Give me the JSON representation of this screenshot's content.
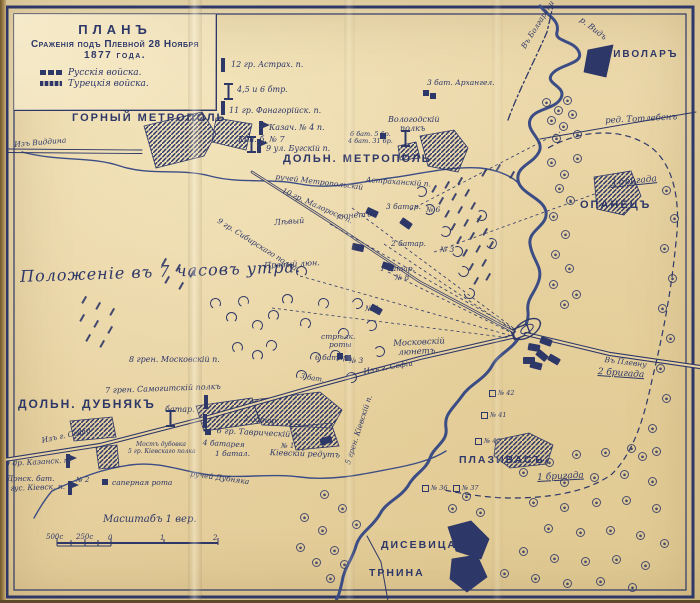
{
  "colors": {
    "ink": "#2d3768",
    "river": "#3c4d85",
    "paper": "#e8d3a3"
  },
  "title_box": {
    "line1": "ПЛАНЪ",
    "line2": "Сраженія подъ Плевной 28 Ноября",
    "line3": "1877 года.",
    "legend": [
      {
        "label": "Русскія войска.",
        "type": "russian"
      },
      {
        "label": "Турецкія войска.",
        "type": "turkish"
      }
    ]
  },
  "annotation": {
    "text": "Положеніе въ 7 часовъ утра."
  },
  "scale": {
    "label": "Масштабъ 1 вер.",
    "ticks": [
      {
        "t": "500с",
        "x": 46,
        "y": 533
      },
      {
        "t": "250с",
        "x": 76,
        "y": 533
      },
      {
        "t": "0",
        "x": 108,
        "y": 534
      },
      {
        "t": "1",
        "x": 160,
        "y": 534
      },
      {
        "t": "2",
        "x": 213,
        "y": 534
      }
    ]
  },
  "towns": [
    {
      "t": "ГОРНЫЙ МЕТРОПОЛЬ",
      "x": 72,
      "y": 112,
      "s": 11
    },
    {
      "t": "ДОЛЬН. МЕТРОПОЛЬ",
      "x": 283,
      "y": 153,
      "s": 11
    },
    {
      "t": "БИВОЛАРЪ",
      "x": 604,
      "y": 49,
      "s": 10
    },
    {
      "t": "ОПАНЕЦЪ",
      "x": 580,
      "y": 199,
      "s": 11
    },
    {
      "t": "ДОЛЬН. ДУБНЯКЪ",
      "x": 18,
      "y": 397,
      "s": 12
    },
    {
      "t": "ПЛАЗИВАСЪ",
      "x": 459,
      "y": 454,
      "s": 10.5
    },
    {
      "t": "ДИСЕВИЦА",
      "x": 381,
      "y": 539,
      "s": 10.5
    },
    {
      "t": "ТРНИНА",
      "x": 369,
      "y": 567,
      "s": 10.5
    }
  ],
  "labels": [
    {
      "t": "Изъ Виддина",
      "x": 14,
      "y": 141,
      "s": 7.5,
      "r": -5
    },
    {
      "t": "12 гр. Астрах. п.",
      "x": 231,
      "y": 61,
      "s": 8
    },
    {
      "t": "4,5 и 6 бтр.",
      "x": 237,
      "y": 86,
      "s": 8
    },
    {
      "t": "11 гр. Фанагорійск. п.",
      "x": 229,
      "y": 107,
      "s": 8
    },
    {
      "t": "Казач. № 4 п.",
      "x": 269,
      "y": 124,
      "s": 8
    },
    {
      "t": "Кон. б. № 7",
      "x": 238,
      "y": 136,
      "s": 8
    },
    {
      "t": "9 ул. Бугскій п.",
      "x": 266,
      "y": 145,
      "s": 8
    },
    {
      "t": "Вологодскій",
      "x": 388,
      "y": 116,
      "s": 8
    },
    {
      "t": "полкъ",
      "x": 400,
      "y": 125,
      "s": 8
    },
    {
      "t": "6 бат. 5 бр.",
      "x": 350,
      "y": 131,
      "s": 6.5
    },
    {
      "t": "4 бат. 31 бр.",
      "x": 348,
      "y": 138,
      "s": 6.5
    },
    {
      "t": "3 бат. Архангел.",
      "x": 427,
      "y": 79,
      "s": 7.5
    },
    {
      "t": "Въ Болгарени",
      "x": 520,
      "y": 46,
      "s": 7.5,
      "r": -58
    },
    {
      "t": "р. Видъ",
      "x": 583,
      "y": 16,
      "s": 8,
      "r": 38
    },
    {
      "t": "ред. Тотлебенъ",
      "x": 605,
      "y": 117,
      "s": 8.5,
      "r": -3
    },
    {
      "t": "3 бригада",
      "x": 610,
      "y": 180,
      "s": 9,
      "r": -6,
      "u": 1
    },
    {
      "t": "ручей Метропольскій",
      "x": 276,
      "y": 173,
      "s": 7.5,
      "r": 7
    },
    {
      "t": "10 гр. Малоросс. п.",
      "x": 284,
      "y": 187,
      "s": 7.5,
      "r": 24
    },
    {
      "t": "9 гр. Сибирскаго полка",
      "x": 220,
      "y": 217,
      "s": 7.5,
      "r": 32
    },
    {
      "t": "Астраханскій п.",
      "x": 366,
      "y": 176,
      "s": 7.5,
      "r": 4
    },
    {
      "t": "Лѣвый",
      "x": 274,
      "y": 219,
      "s": 8,
      "r": -4
    },
    {
      "t": "люнетъ",
      "x": 336,
      "y": 213,
      "s": 8,
      "r": -4
    },
    {
      "t": "3 батар.",
      "x": 386,
      "y": 203,
      "s": 7.5
    },
    {
      "t": "№ 6",
      "x": 426,
      "y": 206,
      "s": 7.5
    },
    {
      "t": "2 батар.",
      "x": 391,
      "y": 240,
      "s": 7.5
    },
    {
      "t": "№ 3",
      "x": 440,
      "y": 246,
      "s": 7.5
    },
    {
      "t": "1 батар.",
      "x": 380,
      "y": 265,
      "s": 7.5
    },
    {
      "t": "№ 8",
      "x": 395,
      "y": 274,
      "s": 7.5
    },
    {
      "t": "Правый люн.",
      "x": 264,
      "y": 262,
      "s": 8,
      "r": -3
    },
    {
      "t": "№ 1",
      "x": 365,
      "y": 305,
      "s": 7.5
    },
    {
      "t": "стрѣлк.",
      "x": 321,
      "y": 333,
      "s": 7.5
    },
    {
      "t": "роты",
      "x": 329,
      "y": 341,
      "s": 7.5
    },
    {
      "t": "Московскій",
      "x": 393,
      "y": 340,
      "s": 8.5,
      "r": -3
    },
    {
      "t": "люнетъ",
      "x": 398,
      "y": 349,
      "s": 8.5,
      "r": -3
    },
    {
      "t": "8 грен. Московскій п.",
      "x": 129,
      "y": 356,
      "s": 8
    },
    {
      "t": "6 батар.",
      "x": 315,
      "y": 354,
      "s": 7.5
    },
    {
      "t": "№ 3",
      "x": 349,
      "y": 357,
      "s": 7.5
    },
    {
      "t": "3 бат.",
      "x": 301,
      "y": 373,
      "s": 7,
      "r": 10
    },
    {
      "t": "Изъ г. Софіи",
      "x": 363,
      "y": 368,
      "s": 7.5,
      "r": -10
    },
    {
      "t": "7 грен. Самогитскій полкъ",
      "x": 105,
      "y": 387,
      "s": 8,
      "r": -2
    },
    {
      "t": "батар.",
      "x": 165,
      "y": 406,
      "s": 8
    },
    {
      "t": "Изъ г. Софіи",
      "x": 41,
      "y": 437,
      "s": 7.5,
      "r": -12
    },
    {
      "t": "3 батар.",
      "x": 244,
      "y": 415,
      "s": 7.5,
      "r": 4
    },
    {
      "t": "№ 2",
      "x": 287,
      "y": 420,
      "s": 7
    },
    {
      "t": "6 гр. Таврическій п.",
      "x": 217,
      "y": 427,
      "s": 8,
      "r": 3
    },
    {
      "t": "4 батарея",
      "x": 203,
      "y": 439,
      "s": 7.5,
      "r": 3
    },
    {
      "t": "№ 1",
      "x": 281,
      "y": 443,
      "s": 7
    },
    {
      "t": "1 батал.",
      "x": 215,
      "y": 450,
      "s": 7.5
    },
    {
      "t": "Кіевскій редутъ",
      "x": 270,
      "y": 449,
      "s": 8,
      "r": 2
    },
    {
      "t": "Мостъ дубовка",
      "x": 136,
      "y": 442,
      "s": 6
    },
    {
      "t": "5 гр. Кіевскаго полка",
      "x": 128,
      "y": 449,
      "s": 6
    },
    {
      "t": "ручей Дубняка",
      "x": 191,
      "y": 470,
      "s": 7.5,
      "r": 8
    },
    {
      "t": "5 грен. Кіевскій п.",
      "x": 344,
      "y": 463,
      "s": 7.5,
      "r": -72
    },
    {
      "t": "9 др. Казанск. п.",
      "x": 5,
      "y": 460,
      "s": 7.5,
      "r": -3
    },
    {
      "t": "Донск. бат.",
      "x": 7,
      "y": 475,
      "s": 7.5
    },
    {
      "t": "9 гус. Кіевск. п.",
      "x": 3,
      "y": 485,
      "s": 7.5,
      "r": -2
    },
    {
      "t": "№ 2",
      "x": 76,
      "y": 477,
      "s": 7
    },
    {
      "t": "саперная рота",
      "x": 112,
      "y": 479,
      "s": 7.5
    },
    {
      "t": "Въ Плевну",
      "x": 605,
      "y": 356,
      "s": 7.5,
      "r": 7
    },
    {
      "t": "2 бригада",
      "x": 598,
      "y": 368,
      "s": 9,
      "r": 4,
      "u": 1
    },
    {
      "t": "1 бригада",
      "x": 537,
      "y": 474,
      "s": 9,
      "r": -3,
      "u": 1
    }
  ],
  "numboxes": [
    {
      "n": "№ 42",
      "x": 489,
      "y": 389
    },
    {
      "n": "№ 41",
      "x": 481,
      "y": 411
    },
    {
      "n": "№ 40",
      "x": 475,
      "y": 437
    },
    {
      "n": "№ 36",
      "x": 422,
      "y": 484
    },
    {
      "n": "№ 37",
      "x": 453,
      "y": 484
    }
  ],
  "decor": {
    "bushes": [
      [
        542,
        98
      ],
      [
        554,
        106
      ],
      [
        563,
        96
      ],
      [
        547,
        116
      ],
      [
        559,
        122
      ],
      [
        568,
        110
      ],
      [
        573,
        130
      ],
      [
        552,
        134
      ],
      [
        547,
        158
      ],
      [
        560,
        170
      ],
      [
        573,
        154
      ],
      [
        555,
        184
      ],
      [
        566,
        196
      ],
      [
        549,
        212
      ],
      [
        561,
        230
      ],
      [
        551,
        250
      ],
      [
        565,
        264
      ],
      [
        549,
        280
      ],
      [
        572,
        290
      ],
      [
        560,
        300
      ],
      [
        662,
        186
      ],
      [
        670,
        214
      ],
      [
        660,
        244
      ],
      [
        668,
        274
      ],
      [
        658,
        304
      ],
      [
        666,
        334
      ],
      [
        656,
        364
      ],
      [
        662,
        394
      ],
      [
        648,
        424
      ],
      [
        638,
        452
      ],
      [
        519,
        468
      ],
      [
        545,
        458
      ],
      [
        572,
        450
      ],
      [
        601,
        448
      ],
      [
        627,
        444
      ],
      [
        652,
        447
      ],
      [
        560,
        478
      ],
      [
        590,
        473
      ],
      [
        620,
        470
      ],
      [
        648,
        477
      ],
      [
        529,
        498
      ],
      [
        560,
        503
      ],
      [
        592,
        498
      ],
      [
        622,
        496
      ],
      [
        652,
        504
      ],
      [
        544,
        524
      ],
      [
        576,
        528
      ],
      [
        606,
        526
      ],
      [
        636,
        531
      ],
      [
        660,
        539
      ],
      [
        519,
        547
      ],
      [
        550,
        554
      ],
      [
        581,
        557
      ],
      [
        612,
        555
      ],
      [
        641,
        561
      ],
      [
        500,
        569
      ],
      [
        531,
        574
      ],
      [
        563,
        579
      ],
      [
        596,
        577
      ],
      [
        628,
        583
      ],
      [
        300,
        513
      ],
      [
        318,
        526
      ],
      [
        296,
        543
      ],
      [
        330,
        546
      ],
      [
        312,
        558
      ],
      [
        320,
        490
      ],
      [
        338,
        504
      ],
      [
        352,
        520
      ],
      [
        340,
        560
      ],
      [
        326,
        574
      ],
      [
        448,
        504
      ],
      [
        462,
        492
      ],
      [
        476,
        508
      ]
    ],
    "hatches": [
      [
        430,
        188
      ],
      [
        443,
        184
      ],
      [
        456,
        180
      ],
      [
        437,
        200
      ],
      [
        450,
        196
      ],
      [
        463,
        192
      ],
      [
        443,
        213
      ],
      [
        456,
        209
      ],
      [
        469,
        205
      ],
      [
        449,
        226
      ],
      [
        462,
        222
      ],
      [
        475,
        218
      ],
      [
        455,
        239
      ],
      [
        468,
        235
      ],
      [
        481,
        231
      ],
      [
        461,
        252
      ],
      [
        474,
        248
      ],
      [
        487,
        244
      ],
      [
        467,
        266
      ],
      [
        480,
        262
      ],
      [
        472,
        280
      ],
      [
        484,
        276
      ],
      [
        480,
        172
      ],
      [
        494,
        167
      ],
      [
        508,
        174
      ],
      [
        80,
        299
      ],
      [
        94,
        305
      ],
      [
        108,
        311
      ],
      [
        78,
        317
      ],
      [
        92,
        323
      ],
      [
        106,
        329
      ],
      [
        84,
        337
      ],
      [
        98,
        343
      ],
      [
        160,
        261
      ],
      [
        174,
        267
      ],
      [
        188,
        273
      ],
      [
        163,
        279
      ],
      [
        177,
        285
      ]
    ],
    "arcs": [
      [
        238,
        296,
        -20
      ],
      [
        252,
        320,
        10
      ],
      [
        266,
        340,
        30
      ],
      [
        282,
        294,
        0
      ],
      [
        300,
        318,
        15
      ],
      [
        232,
        342,
        -10
      ],
      [
        318,
        298,
        20
      ],
      [
        338,
        328,
        40
      ],
      [
        296,
        266,
        0
      ],
      [
        268,
        310,
        5
      ],
      [
        210,
        298,
        -15
      ],
      [
        226,
        312,
        0
      ],
      [
        424,
        204,
        90
      ],
      [
        440,
        226,
        100
      ],
      [
        452,
        246,
        110
      ],
      [
        458,
        266,
        120
      ],
      [
        464,
        288,
        130
      ],
      [
        416,
        186,
        80
      ],
      [
        476,
        210,
        100
      ],
      [
        486,
        238,
        110
      ],
      [
        296,
        370,
        20
      ],
      [
        252,
        350,
        0
      ],
      [
        352,
        298,
        60
      ],
      [
        366,
        320,
        70
      ],
      [
        330,
        350,
        30
      ],
      [
        374,
        346,
        80
      ],
      [
        346,
        372,
        50
      ],
      [
        310,
        352,
        25
      ]
    ],
    "blobs": [
      [
        366,
        209,
        25
      ],
      [
        400,
        220,
        35
      ],
      [
        352,
        244,
        12
      ],
      [
        382,
        263,
        18
      ],
      [
        370,
        306,
        30
      ],
      [
        320,
        437,
        -20
      ],
      [
        528,
        344,
        10
      ],
      [
        536,
        352,
        40
      ],
      [
        523,
        357,
        0
      ],
      [
        540,
        338,
        20
      ],
      [
        548,
        356,
        30
      ],
      [
        530,
        362,
        15
      ]
    ],
    "bars": [
      [
        221,
        58
      ],
      [
        221,
        101
      ],
      [
        204,
        395
      ],
      [
        203,
        414
      ]
    ],
    "flags": [
      [
        259,
        121
      ],
      [
        257,
        139
      ],
      [
        66,
        454
      ],
      [
        68,
        481
      ]
    ],
    "ibeams": [
      [
        224,
        83
      ],
      [
        247,
        136
      ],
      [
        401,
        130
      ],
      [
        166,
        410
      ]
    ],
    "squares": [
      [
        380,
        133
      ],
      [
        423,
        90
      ],
      [
        430,
        93
      ],
      [
        337,
        353
      ],
      [
        345,
        355
      ],
      [
        102,
        479
      ],
      [
        205,
        429
      ]
    ]
  }
}
